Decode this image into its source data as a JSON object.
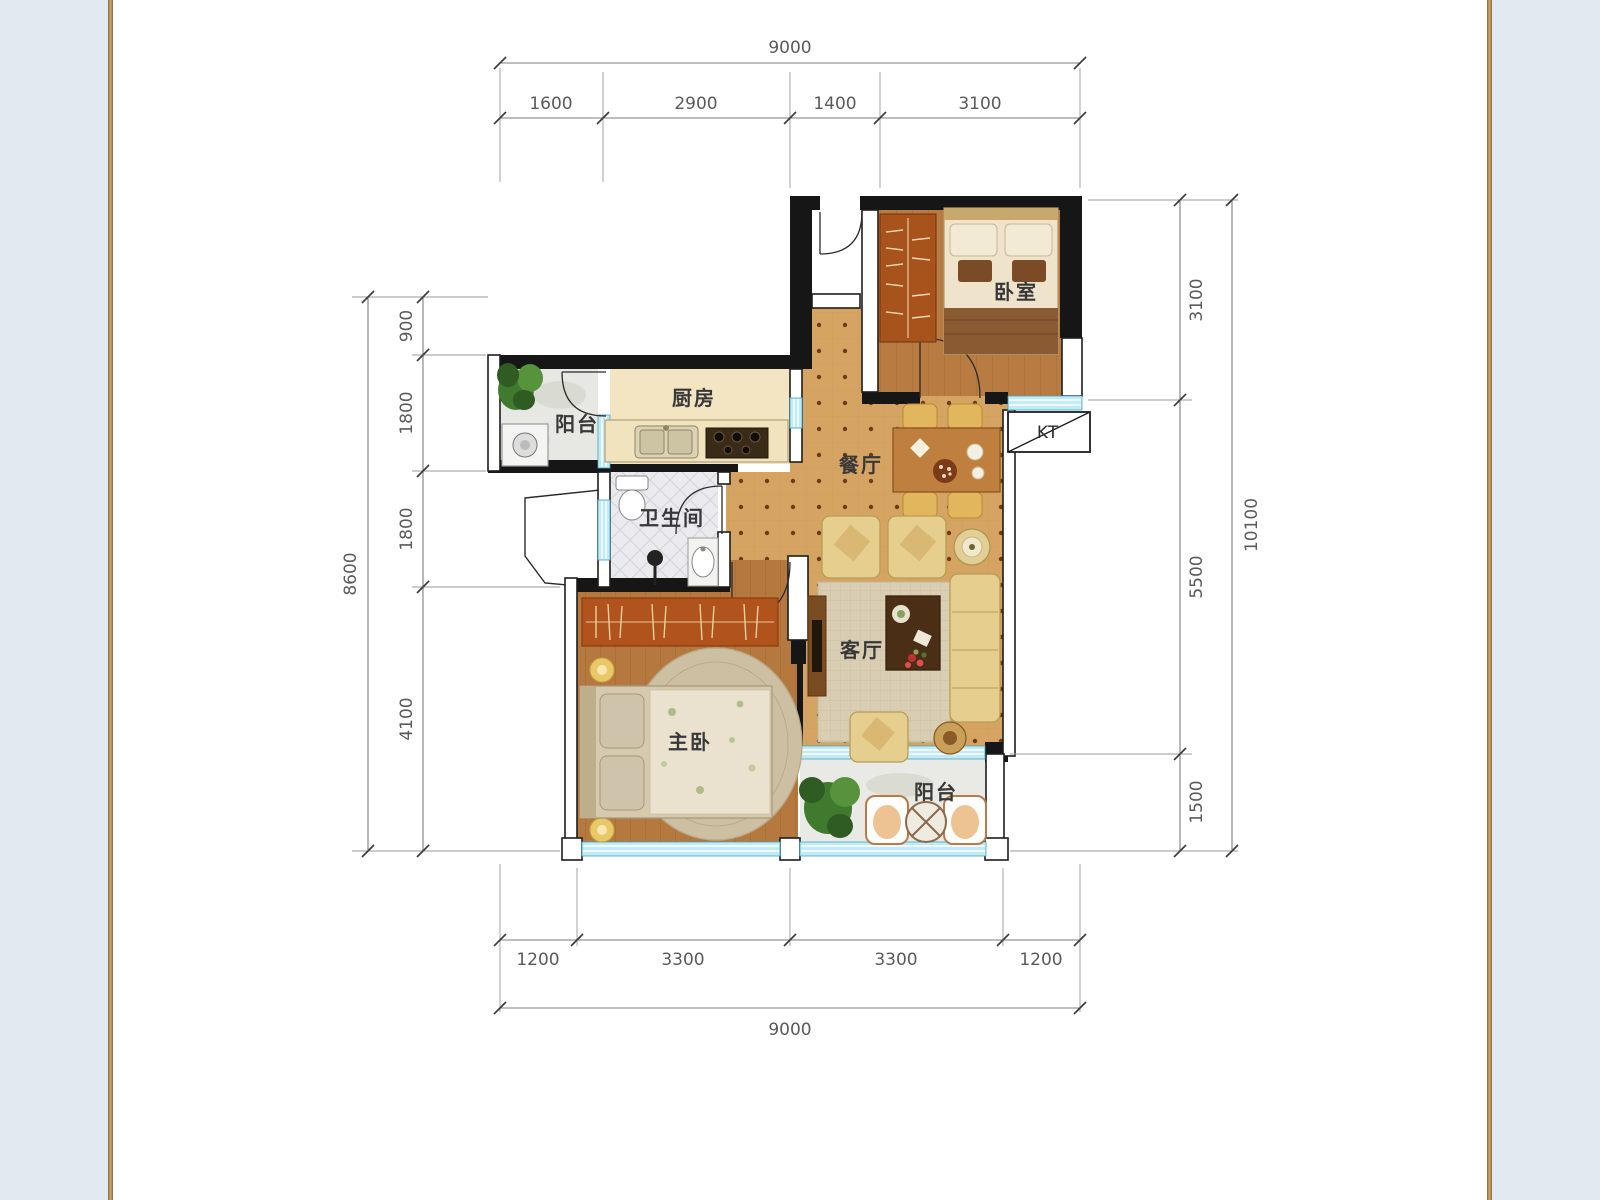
{
  "page": {
    "background": "#e1eaf1",
    "sheet": "#ffffff",
    "frame_gold": "#b3854e"
  },
  "plan": {
    "rooms": [
      {
        "id": "bedroom",
        "label": "卧室"
      },
      {
        "id": "kitchen",
        "label": "厨房"
      },
      {
        "id": "service-balcony",
        "label": "阳台"
      },
      {
        "id": "bathroom",
        "label": "卫生间"
      },
      {
        "id": "dining",
        "label": "餐厅"
      },
      {
        "id": "living",
        "label": "客厅"
      },
      {
        "id": "master-bedroom",
        "label": "主卧"
      },
      {
        "id": "balcony",
        "label": "阳台"
      },
      {
        "id": "ac-unit",
        "label": "KT"
      }
    ]
  },
  "dimensions": {
    "top": {
      "total": "9000",
      "segments": [
        "1600",
        "2900",
        "1400",
        "3100"
      ]
    },
    "bottom": {
      "total": "9000",
      "segments": [
        "1200",
        "3300",
        "3300",
        "1200"
      ]
    },
    "left": {
      "total": "8600",
      "segments": [
        "900",
        "1800",
        "1800",
        "4100"
      ]
    },
    "right": {
      "total": "10100",
      "segments": [
        "3100",
        "5500",
        "1500"
      ]
    }
  },
  "colors": {
    "wall": "#161616",
    "window": "#c2ebf6",
    "tile": "#d5a462",
    "wood_bedroom": "#b87b41",
    "wood_master": "#b5793f",
    "kitchen_floor": "#f3e4c2",
    "rug": "#d9ceb3",
    "dim_text": "#5a5a5a"
  }
}
